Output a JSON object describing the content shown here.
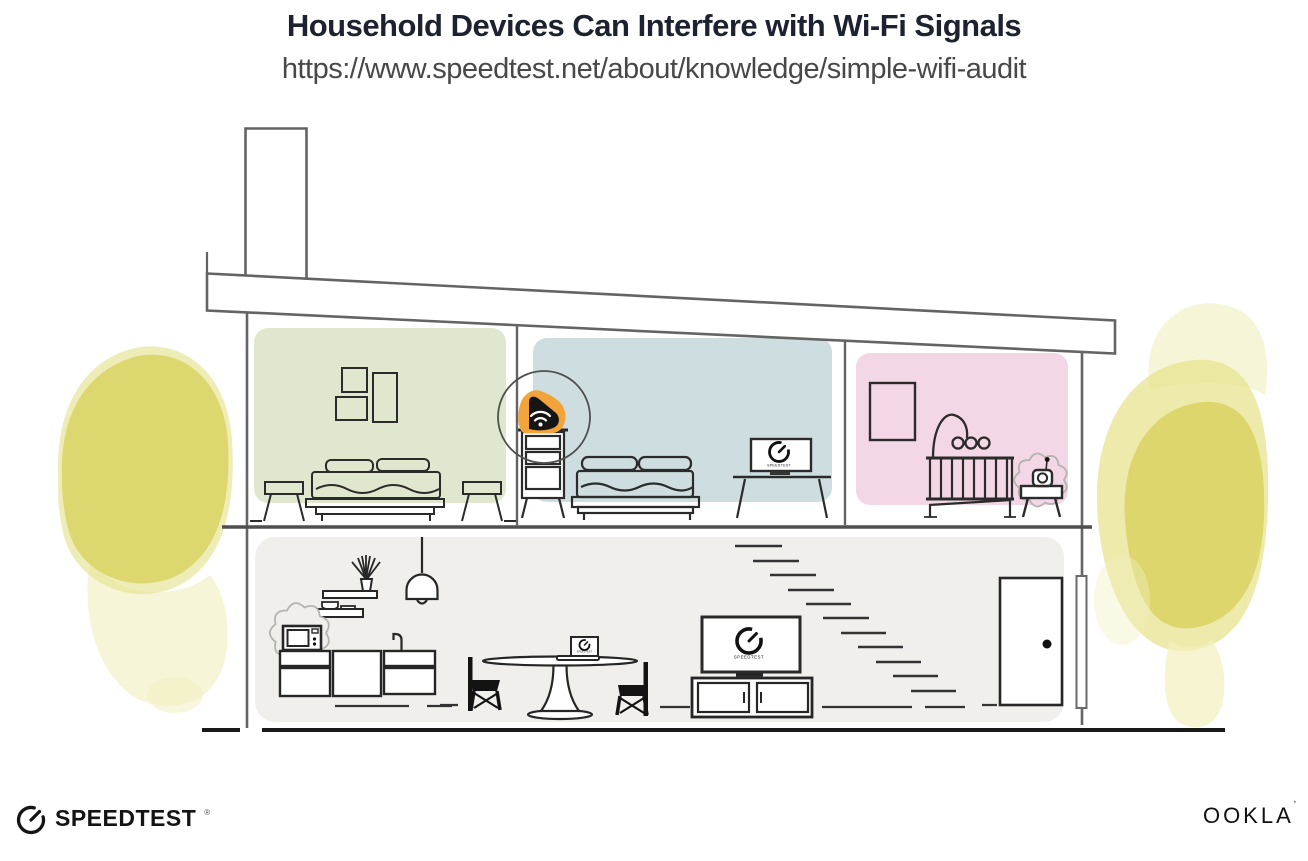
{
  "header": {
    "title": "Household Devices Can Interfere with Wi-Fi Signals",
    "url": "https://www.speedtest.net/about/knowledge/simple-wifi-audit"
  },
  "footer": {
    "speedtest": {
      "wordmark": "SPEEDTEST",
      "registered_mark": "®"
    },
    "ookla": {
      "wordmark": "OOKLA",
      "trademark_mark": "’"
    }
  },
  "illustration": {
    "screens": {
      "tv": "SPEEDTEST",
      "desk_monitor": "SPEEDTEST",
      "laptop": "SPEEDTEST"
    },
    "rooms": [
      {
        "name": "bedroom-left",
        "color_key": "room_green"
      },
      {
        "name": "bedroom-middle",
        "color_key": "room_blue"
      },
      {
        "name": "nursery",
        "color_key": "room_pink"
      },
      {
        "name": "main-floor",
        "color_key": "floor_gray"
      }
    ],
    "devices": [
      {
        "name": "wifi-router",
        "highlighted": true,
        "icon": "wifi-icon"
      },
      {
        "name": "microwave",
        "highlighted": true,
        "icon": "interference-burst"
      },
      {
        "name": "baby-monitor",
        "highlighted": true,
        "icon": "interference-burst"
      },
      {
        "name": "tv",
        "icon": "speedtest-gauge-icon"
      },
      {
        "name": "desk-monitor",
        "icon": "speedtest-gauge-icon"
      },
      {
        "name": "laptop",
        "icon": "speedtest-gauge-icon"
      }
    ],
    "colors": {
      "room_green": "#dfe8cf",
      "room_blue": "#cedee0",
      "room_pink": "#f3d7e6",
      "floor_gray": "#f0efec",
      "tree_dark": "#d9d466",
      "tree_mid": "#e7e390",
      "tree_light": "#f2efbd",
      "router_orange": "#f2a43b",
      "line_wall": "#646464",
      "line_furniture": "#262626",
      "line_ground": "#191919",
      "burst_outline": "#b3b3b0",
      "title_text": "#1d2230",
      "url_text": "#484848"
    }
  }
}
